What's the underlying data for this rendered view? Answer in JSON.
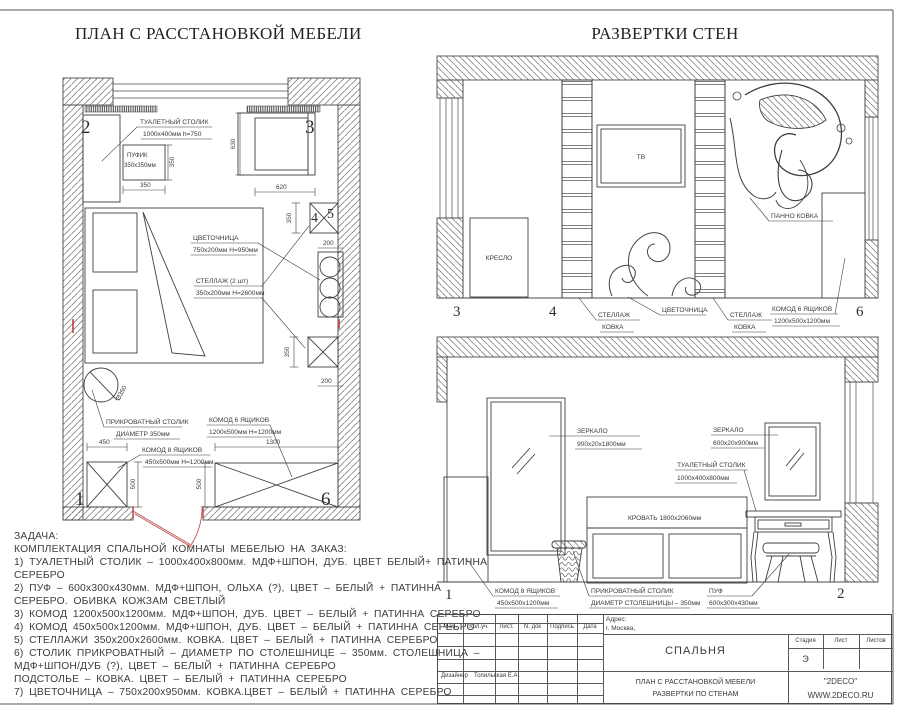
{
  "titles": {
    "plan": "ПЛАН С РАССТАНОВКОЙ МЕБЕЛИ",
    "elev": "РАЗВЕРТКИ СТЕН"
  },
  "plan": {
    "markers": {
      "m1": "1",
      "m2": "2",
      "m3": "3",
      "m4": "4",
      "m5": "5",
      "m6": "6"
    },
    "callouts": {
      "dressing": {
        "l1": "ТУАЛЕТНЫЙ СТОЛИК",
        "l2": "1000x400мм  h=750"
      },
      "pouf": {
        "l1": "ПУФИК",
        "l2": "350x350мм"
      },
      "planter": {
        "l1": "ЦВЕТОЧНИЦА",
        "l2": "750x200мм  H=950мм"
      },
      "shelf": {
        "l1": "СТЕЛЛАЖ (2 шт)",
        "l2": "350x200мм  H=2600мм"
      },
      "bedside": {
        "l1": "ПРИКРОВАТНЫЙ СТОЛИК",
        "l2": "ДИАМЕТР 350мм"
      },
      "chest8": {
        "l1": "КОМОД 8 ЯЩИКОВ",
        "l2": "450x500мм  H=1200мм"
      },
      "chest6": {
        "l1": "КОМОД 6 ЯЩИКОВ",
        "l2": "1200x500мм  H=1200мм"
      },
      "diameter": "Ø350"
    },
    "dims": {
      "pouf_w": "350",
      "pouf_d": "350",
      "armchair_h": "630",
      "armchair_w": "620",
      "shelf1": "350",
      "planter_w": "200",
      "shelf2": "350",
      "gap": "200",
      "chest8_w": "450",
      "chest8_d": "500",
      "chest6_w": "1300",
      "chest6_d": "500"
    }
  },
  "elev_top": {
    "markers": {
      "m3": "3",
      "m4": "4",
      "m6": "6"
    },
    "labels": {
      "armchair": "КРЕСЛО",
      "tv": "ТВ",
      "panel": "ПАННО КОВКА",
      "shelf1_l1": "СТЕЛЛАЖ",
      "shelf1_l2": "КОВКА",
      "planter": "ЦВЕТОЧНИЦА",
      "shelf2_l1": "СТЕЛЛАЖ",
      "shelf2_l2": "КОВКА",
      "chest6_l1": "КОМОД 6 ЯЩИКОВ",
      "chest6_l2": "1200x500x1200мм"
    }
  },
  "elev_bottom": {
    "markers": {
      "m1": "1",
      "m2": "2"
    },
    "labels": {
      "mirror1_l1": "ЗЕРКАЛО",
      "mirror1_l2": "900x20x1800мм",
      "mirror2_l1": "ЗЕРКАЛО",
      "mirror2_l2": "600x20x900мм",
      "dressing_l1": "ТУАЛЕТНЫЙ СТОЛИК",
      "dressing_l2": "1000x400x800мм",
      "bed": "КРОВАТЬ 1800x2060мм",
      "chest8_l1": "КОМОД 8 ЯЩИКОВ",
      "chest8_l2": "450x500x1200мм",
      "bedside_l1": "ПРИКРОВАТНЫЙ СТОЛИК",
      "bedside_l2": "ДИАМЕТР СТОЛЕШНИЦЫ – 350мм",
      "pouf_l1": "ПУФ",
      "pouf_l2": "600x300x430мм"
    }
  },
  "task": {
    "lines": [
      "ЗАДАЧА:",
      "КОМПЛЕКТАЦИЯ СПАЛЬНОЙ КОМНАТЫ МЕБЕЛЬЮ НА ЗАКАЗ:",
      "1) ТУАЛЕТНЫЙ СТОЛИК – 1000x400x800мм. МДФ+ШПОН, ДУБ. ЦВЕТ БЕЛЫЙ+ ПАТИННА",
      "СЕРЕБРО",
      "2) ПУФ – 600x300x430мм. МДФ+ШПОН, ОЛЬХА (?), ЦВЕТ – БЕЛЫЙ + ПАТИННА",
      "СЕРЕБРО. ОБИВКА КОЖЗАМ СВЕТЛЫЙ",
      "3) КОМОД 1200x500x1200мм. МДФ+ШПОН, ДУБ. ЦВЕТ – БЕЛЫЙ + ПАТИННА СЕРЕБРО",
      "4) КОМОД 450x500x1200мм. МДФ+ШПОН, ДУБ. ЦВЕТ – БЕЛЫЙ + ПАТИННА СЕРЕБРО",
      "5) СТЕЛЛАЖИ 350x200x2600мм. КОВКА. ЦВЕТ – БЕЛЫЙ + ПАТИННА СЕРЕБРО",
      "6) СТОЛИК ПРИКРОВАТНЫЙ – ДИАМЕТР ПО СТОЛЕШНИЦЕ – 350мм. СТОЛЕШНИЦА –",
      "МДФ+ШПОН/ДУБ (?), ЦВЕТ – БЕЛЫЙ + ПАТИННА СЕРЕБРО",
      "ПОДСТОЛЬЕ – КОВКА. ЦВЕТ – БЕЛЫЙ + ПАТИННА СЕРЕБРО",
      "7) ЦВЕТОЧНИЦА – 750x200x950мм. КОВКА.ЦВЕТ – БЕЛЫЙ + ПАТИННА СЕРЕБРО"
    ]
  },
  "titleblock": {
    "cols": {
      "izm": "Изм.",
      "kol": "Кол.уч.",
      "list": "Лист.",
      "ndok": "N. док",
      "podpis": "Подпись",
      "date": "Дата"
    },
    "address_label": "Адрес:",
    "address_value": "г. Москва,",
    "project": "СПАЛЬНЯ",
    "stage_label": "Стадия",
    "sheet_label": "Лист",
    "sheets_label": "Листов",
    "stage_value": "Э",
    "designer_label": "Дизайнер",
    "designer_name": "Топильская Е.А",
    "doc_line1": "ПЛАН С РАССТАНОВКОЙ МЕБЕЛИ",
    "doc_line2": "РАЗВЕРТКИ ПО СТЕНАМ",
    "brand": "\"2DECO\"",
    "site": "WWW.2DECO.RU"
  },
  "colors": {
    "line": "#3f3f3f",
    "red": "#c05050"
  }
}
